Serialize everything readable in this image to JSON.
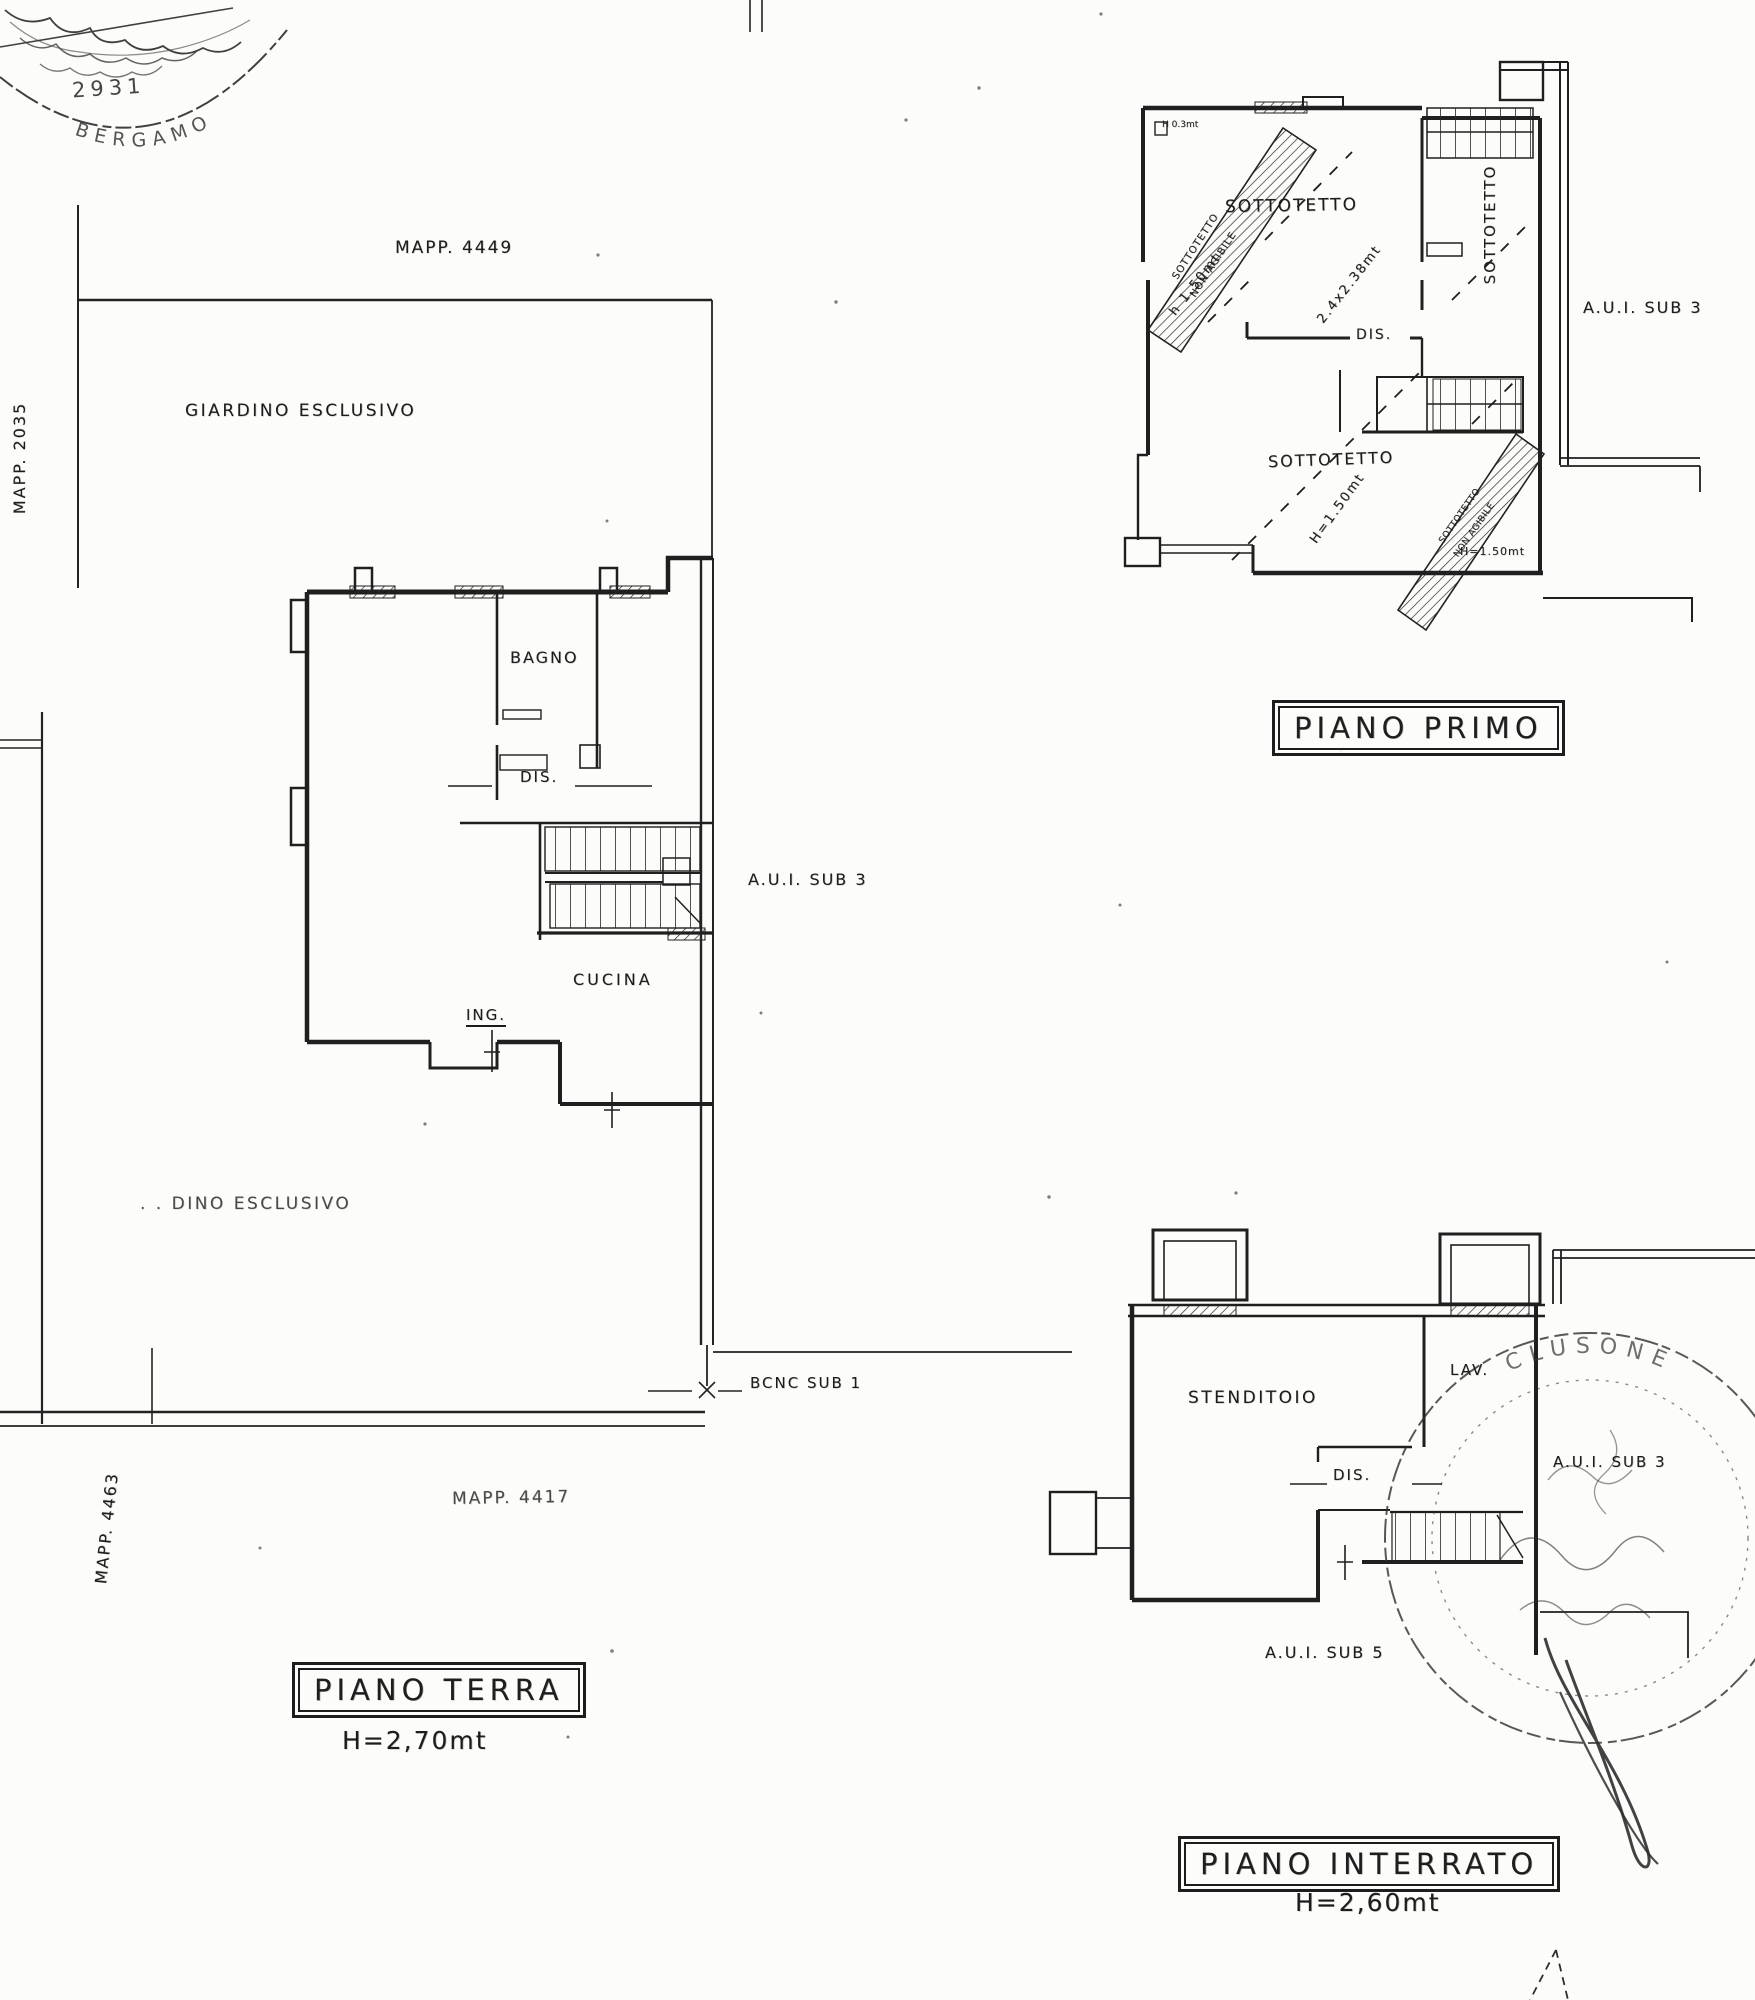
{
  "colors": {
    "paper": "#fcfcfa",
    "ink": "#1f1f1f"
  },
  "stamp_top_left": {
    "number": "2931",
    "arc_text": "BERGAMO"
  },
  "stamp_bottom_right": {
    "arc_text": "CLUSONE"
  },
  "ground_floor": {
    "mapp_4449": "MAPP. 4449",
    "mapp_2035": "MAPP. 2035",
    "mapp_4463": "MAPP. 4463",
    "mapp_4417": "MAPP. 4417",
    "giardino_top": "GIARDINO ESCLUSIVO",
    "giardino_bottom": ". .  DINO ESCLUSIVO",
    "bagno": "BAGNO",
    "dis": "DIS.",
    "cucina": "CUCINA",
    "ing": "ING.",
    "aui_sub3": "A.U.I. SUB 3",
    "bcnc_sub1": "BCNC SUB 1",
    "title": "PIANO TERRA",
    "height": "H=2,70mt"
  },
  "first_floor": {
    "title": "PIANO PRIMO",
    "sottotetto_upper": "SOTTOTETTO",
    "sottotetto_lower": "SOTTOTETTO",
    "sottotetto_right": "SOTTOTETTO",
    "dis": "DIS.",
    "hatch_line1": "SOTTOTETTO",
    "hatch_line2": "NON AGIBILE",
    "dim_corner": "H 0.3mt",
    "dim_h150_diag": "h 1.50mt",
    "dim_2438": "2.4x2.38mt",
    "dim_h150_lower": "H=1.50mt",
    "dim_h150_small": "H=1.50mt",
    "aui_sub3": "A.U.I. SUB 3"
  },
  "basement": {
    "title": "PIANO INTERRATO",
    "height": "H=2,60mt",
    "stenditoio": "STENDITOIO",
    "lav": "LAV.",
    "dis": "DIS.",
    "aui_sub5": "A.U.I. SUB 5",
    "aui_sub3": "A.U.I. SUB 3"
  }
}
